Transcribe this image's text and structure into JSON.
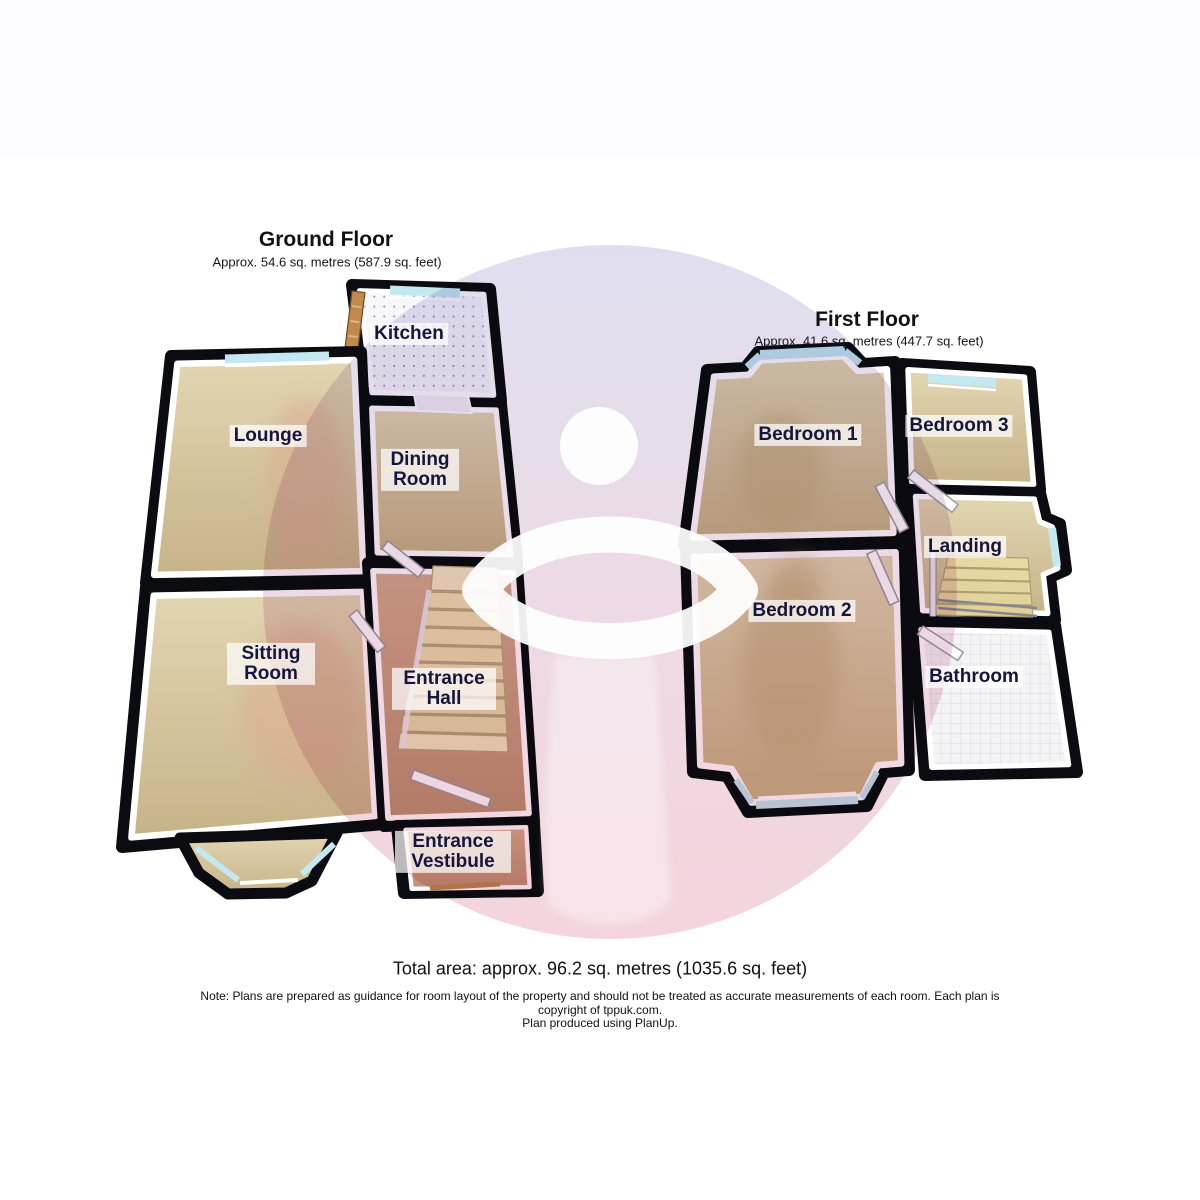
{
  "ground_floor": {
    "title": "Ground Floor",
    "area_text": "Approx. 54.6 sq. metres (587.9 sq. feet)",
    "rooms": [
      {
        "id": "kitchen",
        "label": "Kitchen"
      },
      {
        "id": "lounge",
        "label": "Lounge"
      },
      {
        "id": "dining-room",
        "label": "Dining Room"
      },
      {
        "id": "sitting-room",
        "label": "Sitting Room"
      },
      {
        "id": "entrance-hall",
        "label": "Entrance Hall"
      },
      {
        "id": "entrance-vestibule",
        "label": "Entrance Vestibule"
      }
    ]
  },
  "first_floor": {
    "title": "First Floor",
    "area_text": "Approx. 41.6 sq. metres (447.7 sq. feet)",
    "rooms": [
      {
        "id": "bedroom-1",
        "label": "Bedroom 1"
      },
      {
        "id": "bedroom-3",
        "label": "Bedroom 3"
      },
      {
        "id": "landing",
        "label": "Landing"
      },
      {
        "id": "bedroom-2",
        "label": "Bedroom 2"
      },
      {
        "id": "bathroom",
        "label": "Bathroom"
      }
    ]
  },
  "footer": {
    "total_area": "Total area: approx. 96.2 sq. metres (1035.6 sq. feet)",
    "note_line1": "Note: Plans are prepared as guidance for room layout of the property and should not be treated as accurate measurements of each room. Each plan is",
    "note_line2": "copyright of tppuk.com.",
    "note_line3": "Plan produced using PlanUp."
  },
  "palette": {
    "wall": "#0b0b12",
    "floor_beige": "#d2c096",
    "floor_hall": "#c79b80",
    "kitchen_floor": "#f7f6fb",
    "bathroom_tile": "#f4f4f6",
    "window_glass": "#c4e8ef",
    "stair_tread": "#ecdfb0",
    "door_wood": "#c08a4e",
    "label_text": "#16163c",
    "watermark_top": "#dcdbee",
    "watermark_bottom": "#f3d0d9"
  }
}
